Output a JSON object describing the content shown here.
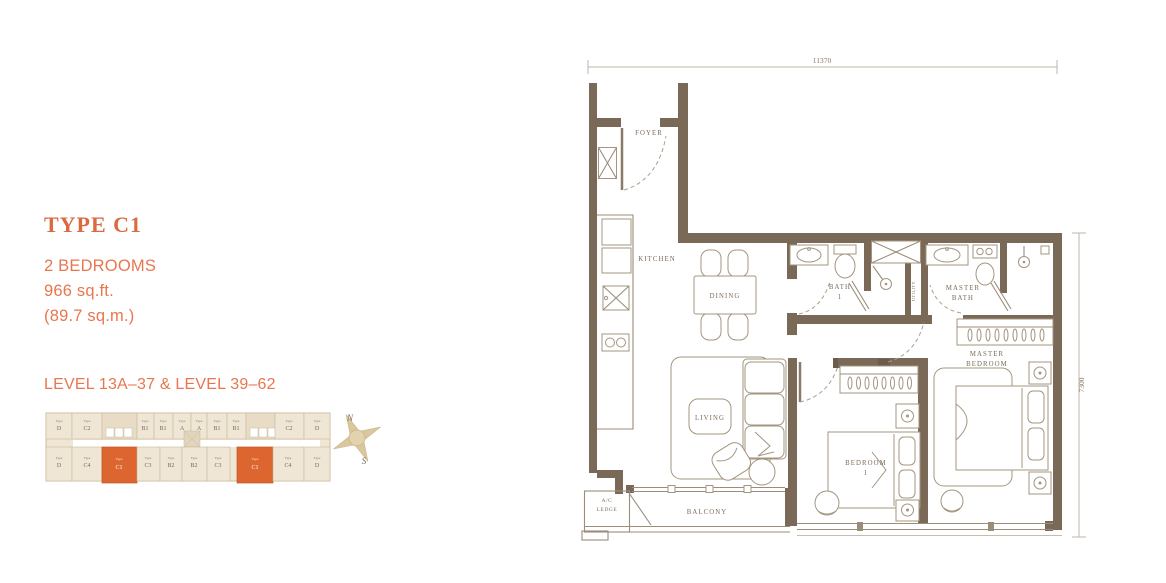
{
  "info": {
    "title": "TYPE C1",
    "bedrooms": "2 BEDROOMS",
    "area_imperial": "966 sq.ft.",
    "area_metric": "(89.7 sq.m.)",
    "levels": "LEVEL 13A–37 & LEVEL 39–62"
  },
  "colors": {
    "accent_orange": "#E8764F",
    "title_orange": "#D96A42",
    "wall_brown": "#7A6957",
    "keyplan_beige": "#EFE6D5",
    "keyplan_highlight": "#DD6630",
    "compass_tan": "#D9C79F",
    "label_brown": "#7B6B58"
  },
  "compass": {
    "north_label": "N",
    "south_label": "S"
  },
  "keyplan": {
    "type_prefix": "Type",
    "top_row": [
      "D",
      "C2",
      "B1",
      "B1",
      "A",
      "A",
      "B1",
      "B1",
      "C2",
      "D"
    ],
    "bottom_row": [
      "D",
      "C4",
      "C1",
      "C3",
      "B2",
      "B2",
      "C3",
      "C1",
      "C4",
      "D"
    ],
    "highlighted_type": "C1"
  },
  "floorplan": {
    "dim_width": "11370",
    "dim_height": "7300",
    "labels": {
      "foyer": "FOYER",
      "kitchen": "KITCHEN",
      "dining": "DINING",
      "bath1_l1": "BATH",
      "bath1_l2": "1",
      "master_bath_l1": "MASTER",
      "master_bath_l2": "BATH",
      "utility": "UTILITY",
      "living": "LIVING",
      "bedroom1_l1": "BEDROOM",
      "bedroom1_l2": "1",
      "master_bedroom_l1": "MASTER",
      "master_bedroom_l2": "BEDROOM",
      "balcony": "BALCONY",
      "ac_ledge_l1": "A/C",
      "ac_ledge_l2": "LEDGE"
    }
  }
}
